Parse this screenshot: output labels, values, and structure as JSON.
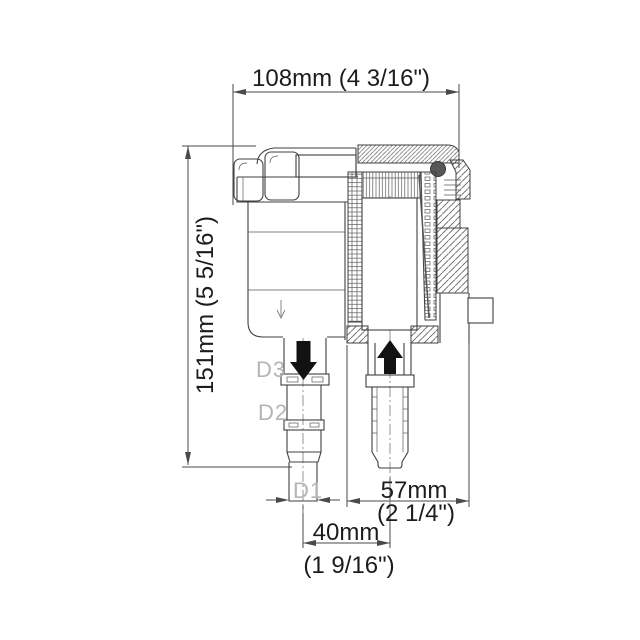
{
  "figure": {
    "type": "technical-drawing",
    "subject": "Raw water strainer cross-section with dimensions",
    "dimensions": {
      "overall_width": "108mm  (4 3/16\")",
      "overall_height": "151mm  (5 5/16\")",
      "outlet_offset_mm": "57mm",
      "outlet_offset_in": "(2 1/4\")",
      "inlet_offset_mm": "40mm",
      "inlet_offset_in": "(1 9/16\")"
    },
    "port_labels": {
      "d1": "D1",
      "d2": "D2",
      "d3": "D3"
    },
    "flow": {
      "inlet_direction": "down",
      "outlet_direction": "up"
    },
    "colors": {
      "line": "#3f3f3f",
      "dim_line": "#4a4a4a",
      "label_gray": "#b4b4b4",
      "flow_arrow": "#121212",
      "oring_dot": "#575757",
      "background": "#ffffff"
    }
  }
}
